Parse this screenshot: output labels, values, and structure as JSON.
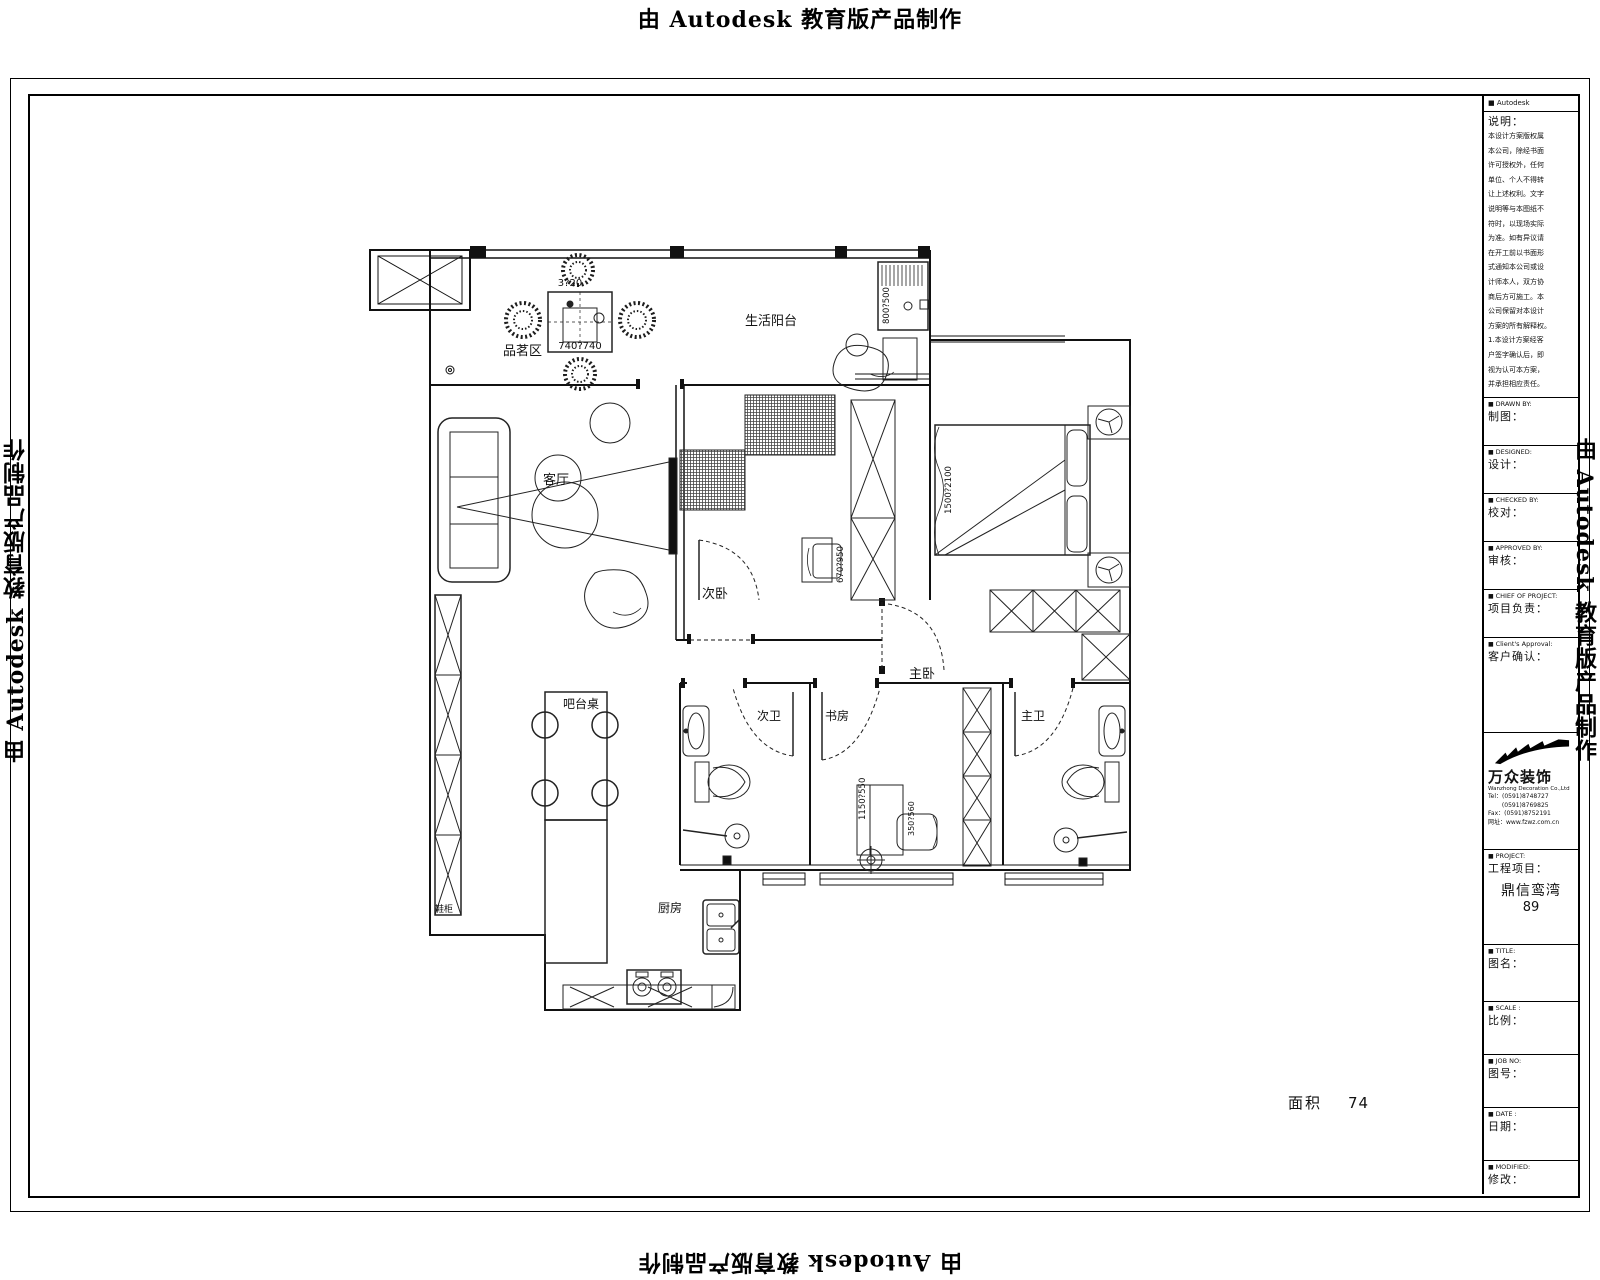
{
  "watermark": {
    "text": "由 Autodesk 教育版产品制作"
  },
  "plan": {
    "labels": {
      "tea_area": "品茗区",
      "balcony": "生活阳台",
      "living": "客厅",
      "second_bedroom": "次卧",
      "master_bedroom": "主卧",
      "second_bath": "次卫",
      "study": "书房",
      "master_bath": "主卫",
      "bar_table": "吧台桌",
      "kitchen": "厨房",
      "shoe_cabinet": "鞋柜"
    },
    "dims": {
      "tea_table": "740?740",
      "tea_table_top": "3?20",
      "washer": "800?500",
      "bed": "1500?2100",
      "bedroom_chair": "670?950",
      "study_desk": "1150?550",
      "study_chair": "350?560"
    },
    "area_label": "面积",
    "area_value": "74"
  },
  "titleblock": {
    "header": "Autodesk",
    "notes_label": "说明：",
    "notes_text": "本设计方案版权属\n本公司，除经书面\n许可授权外，任何\n单位、个人不得转\n让上述权利。文字\n说明等与本图纸不\n符时，以现场实际\n为准。如有异议请\n在开工前以书面形\n式通知本公司或设\n计师本人，双方协\n商后方可施工。本\n公司保留对本设计\n方案的所有解释权。\n1.本设计方案经客\n户签字确认后，即\n视为认可本方案，\n并承担相应责任。",
    "fields": [
      {
        "en": "DRAWN  BY:",
        "zh": "制图："
      },
      {
        "en": "DESIGNED:",
        "zh": "设计："
      },
      {
        "en": "CHECKED  BY:",
        "zh": "校对："
      },
      {
        "en": "APPROVED  BY:",
        "zh": "审核："
      },
      {
        "en": "CHIEF OF PROJECT:",
        "zh": "项目负责："
      },
      {
        "en": "Client's Approval:",
        "zh": "客户确认："
      }
    ],
    "logo": {
      "name": "万众装饰",
      "sub": "Wanzhong Decoration Co.,Ltd",
      "line1": "Tel：(0591)8748727",
      "line2": "　　  (0591)8769825",
      "line3": "Fax：(0591)8752191",
      "line4": "网址：www.fzwz.com.cn"
    },
    "project": {
      "en": "PROJECT:",
      "zh": "工程项目：",
      "name": "鼎信鸾湾",
      "number": "89"
    },
    "bottom_fields": [
      {
        "en": "TITLE:",
        "zh": "图名："
      },
      {
        "en": "SCALE :",
        "zh": "比例："
      },
      {
        "en": "JOB  NO:",
        "zh": "图号："
      },
      {
        "en": "DATE :",
        "zh": "日期："
      },
      {
        "en": "MODIFIED:",
        "zh": "修改："
      }
    ]
  }
}
